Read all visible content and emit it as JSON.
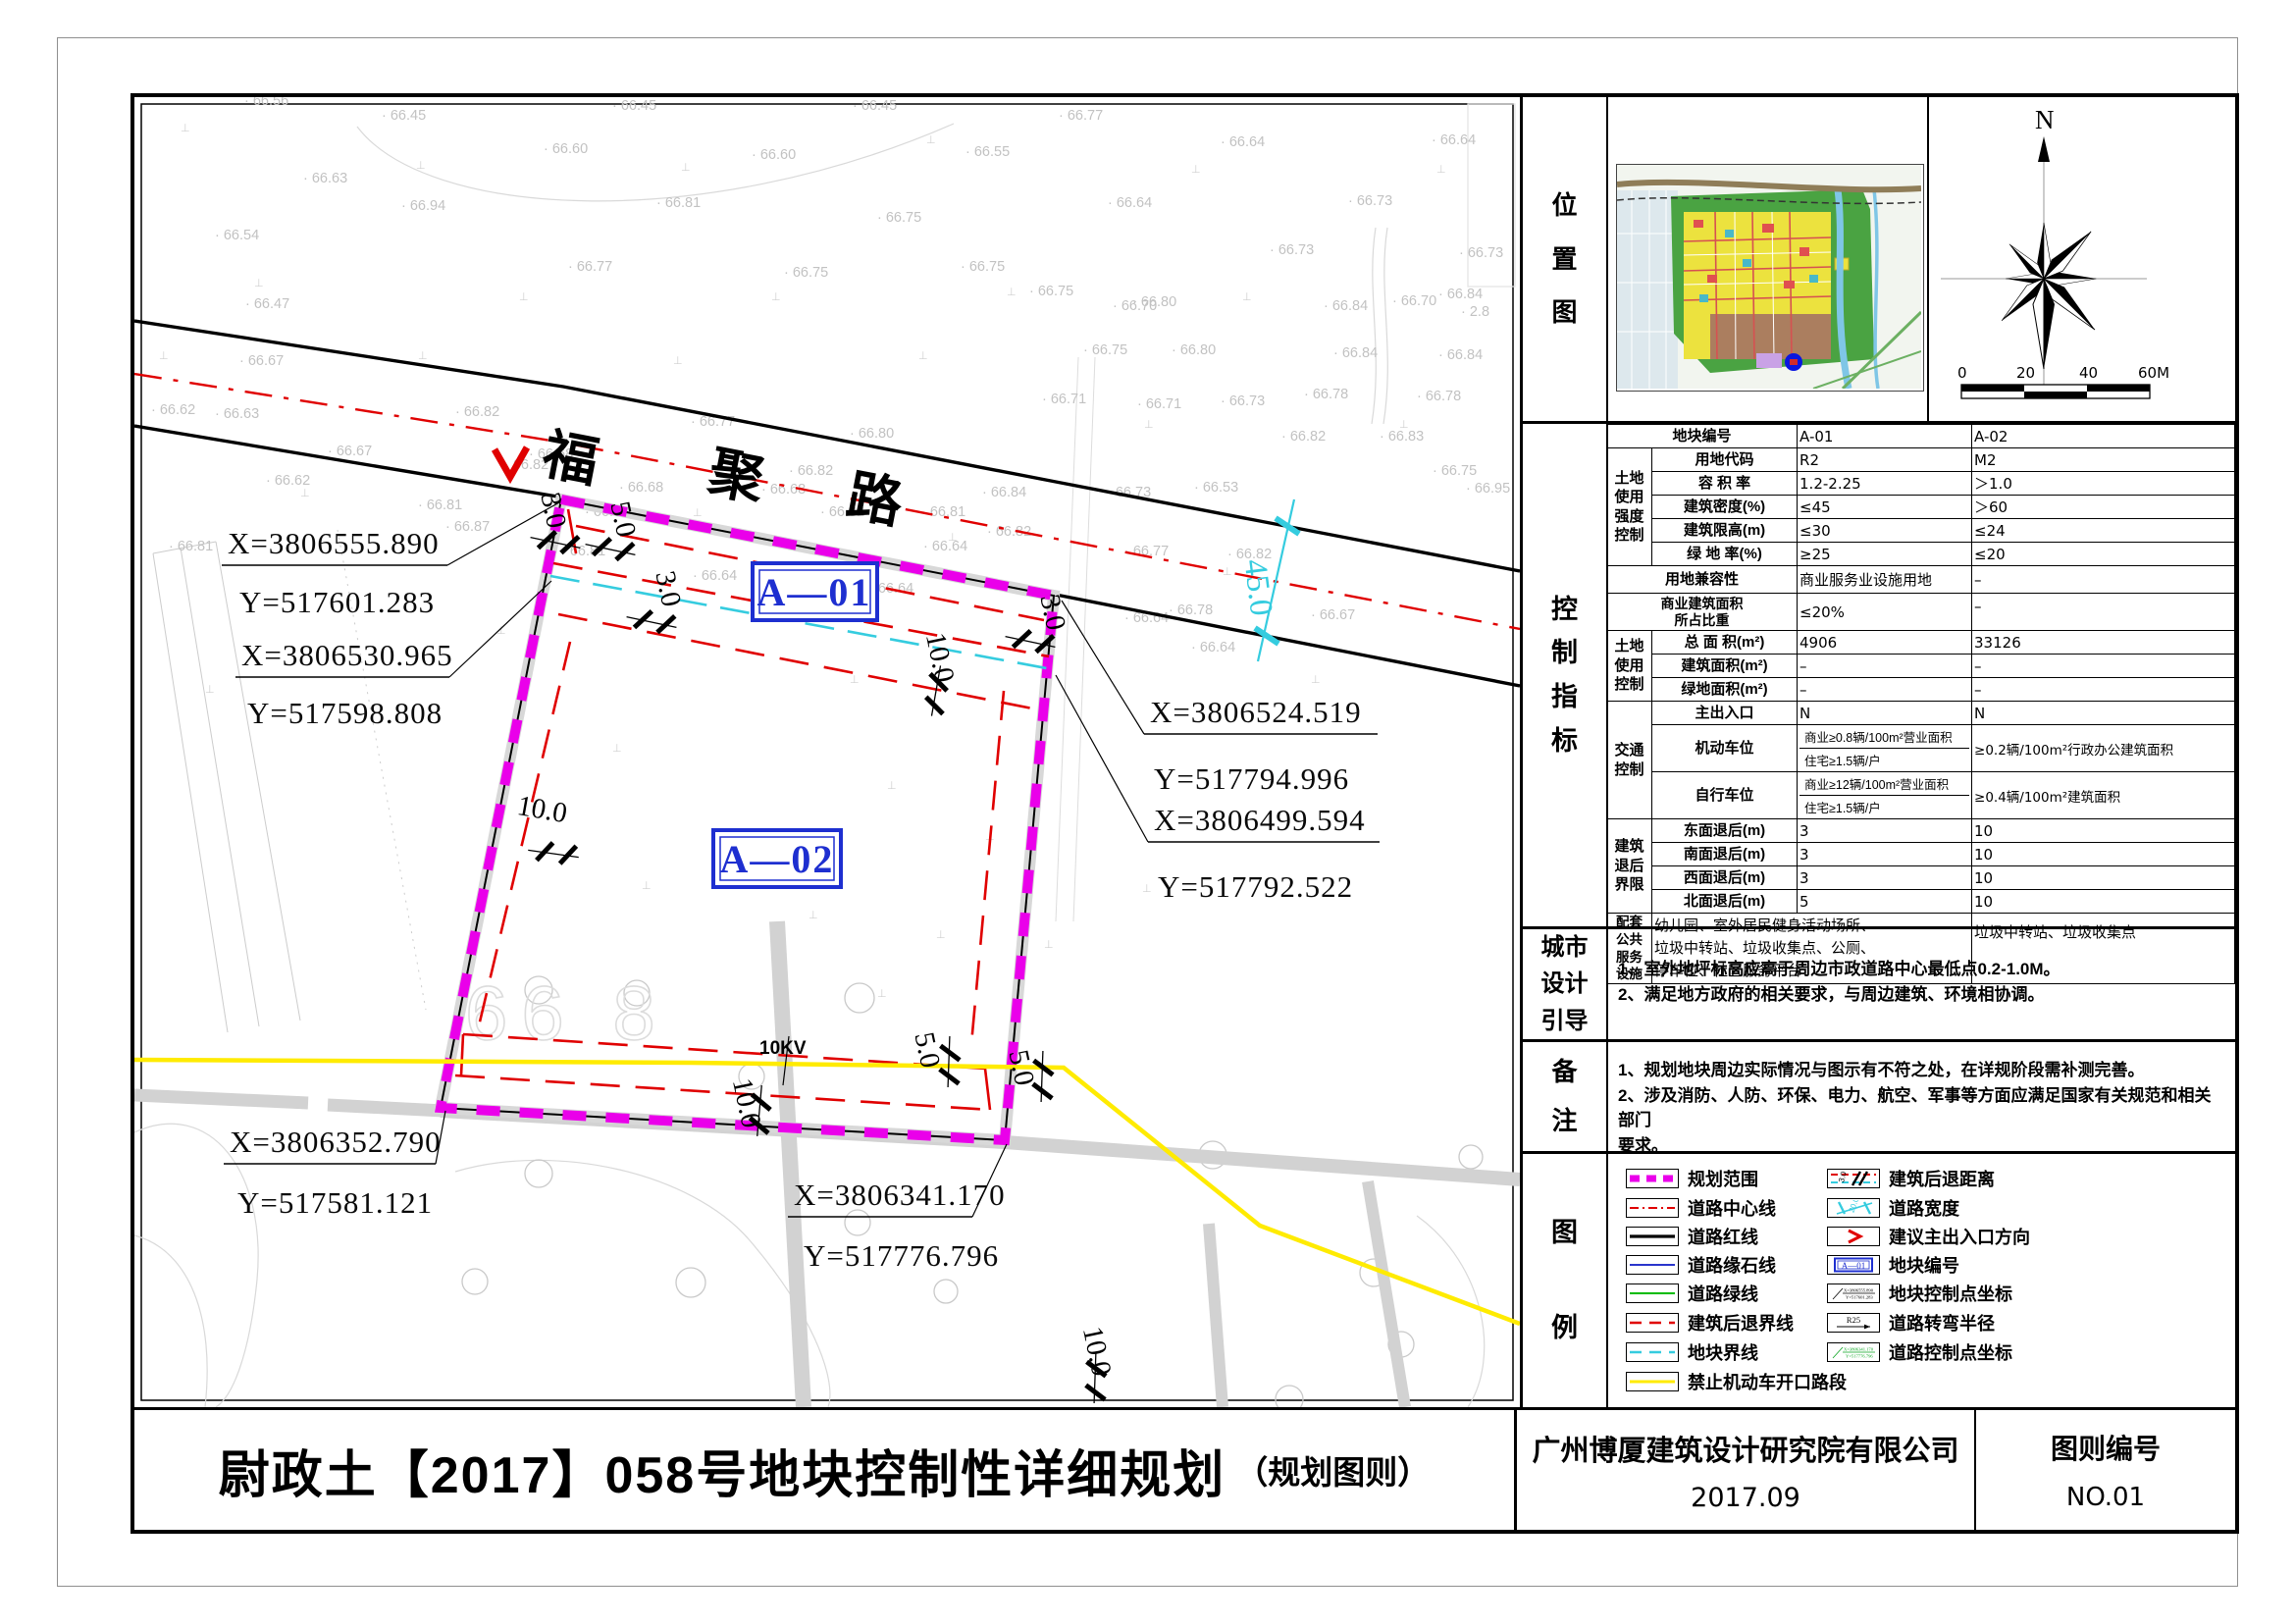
{
  "titleblock": {
    "title": "尉政土【2017】058号地块控制性详细规划",
    "title_suffix": "（规划图则）",
    "company": "广州博厦建筑设计研究院有限公司",
    "date": "2017.09",
    "sheet_label": "图则编号",
    "sheet_no": "NO.01"
  },
  "location": {
    "label": "位\n置\n图",
    "north": "N",
    "scale_ticks": {
      "t0": "0",
      "t1": "20",
      "t2": "40",
      "t3": "60M"
    }
  },
  "indicators": {
    "label": "控\n制\n指\n标",
    "header": {
      "plot_no_label": "地块编号",
      "a01": "A-01",
      "a02": "A-02"
    },
    "groups": {
      "g1": "土地\n使用\n强度\n控制",
      "g2": "土地\n使用\n控制",
      "g3": "交通\n控制",
      "g4": "建筑\n退后\n界限",
      "g5": "配套\n公共\n服务\n设施"
    },
    "rows": {
      "land_code": {
        "label": "用地代码",
        "a01": "R2",
        "a02": "M2"
      },
      "far": {
        "label": "容 积 率",
        "a01": "1.2-2.25",
        "a02": "＞1.0"
      },
      "density": {
        "label": "建筑密度(%)",
        "a01": "≤45",
        "a02": "＞60"
      },
      "height": {
        "label": "建筑限高(m)",
        "a01": "≤30",
        "a02": "≤24"
      },
      "green_rate": {
        "label": "绿 地 率(%)",
        "a01": "≥25",
        "a02": "≤20"
      },
      "compat": {
        "label": "用地兼容性",
        "a01": "商业服务业设施用地",
        "a02": "–"
      },
      "biz_ratio": {
        "label": "商业建筑面积\n所占比重",
        "a01": "≤20%",
        "a02": "–"
      },
      "total_area": {
        "label": "总 面 积(m²)",
        "a01": "4906",
        "a02": "33126"
      },
      "build_area": {
        "label": "建筑面积(m²)",
        "a01": "–",
        "a02": "–"
      },
      "green_area": {
        "label": "绿地面积(m²)",
        "a01": "–",
        "a02": "–"
      },
      "entrance": {
        "label": "主出入口",
        "a01": "N",
        "a02": "N"
      },
      "parking": {
        "label": "机动车位",
        "a01_top": "商业≥0.8辆/100m²营业面积",
        "a01_bottom": "住宅≥1.5辆/户",
        "a02": "≥0.2辆/100m²行政办公建筑面积"
      },
      "bike": {
        "label": "自行车位",
        "a01_top": "商业≥12辆/100m²营业面积",
        "a01_bottom": "住宅≥1.5辆/户",
        "a02": "≥0.4辆/100m²建筑面积"
      },
      "east": {
        "label": "东面退后(m)",
        "a01": "3",
        "a02": "10"
      },
      "south": {
        "label": "南面退后(m)",
        "a01": "3",
        "a02": "10"
      },
      "west": {
        "label": "西面退后(m)",
        "a01": "3",
        "a02": "10"
      },
      "north": {
        "label": "北面退后(m)",
        "a01": "5",
        "a02": "10"
      },
      "services": {
        "a01": "幼儿园、室外居民健身活动场所、\n垃圾中转站、垃圾收集点、公厕、\n停车位、社区服务平台",
        "a02": "垃圾中转站、垃圾收集点"
      }
    }
  },
  "urban_design": {
    "label": "城市\n设计\n引导",
    "line1": "1、室外地坪标高应高于周边市政道路中心最低点0.2-1.0M。",
    "line2": "2、满足地方政府的相关要求，与周边建筑、环境相协调。"
  },
  "notes": {
    "label": "备\n注",
    "line1": "1、规划地块周边实际情况与图示有不符之处，在详规阶段需补测完善。",
    "line2": "2、涉及消防、人防、环保、电力、航空、军事等方面应满足国家有关规范和相关部门",
    "line3": "要求。"
  },
  "legend": {
    "label": "图\n例",
    "left": [
      "规划范围",
      "道路中心线",
      "道路红线",
      "道路缘石线",
      "道路绿线",
      "建筑后退界线",
      "地块界线",
      "禁止机动车开口路段"
    ],
    "right": [
      "建筑后退距离",
      "道路宽度",
      "建议主出入口方向",
      "地块编号",
      "地块控制点坐标",
      "道路转弯半径",
      "道路控制点坐标"
    ],
    "sym": {
      "setback_dim": "3.0",
      "road_width": "20.0",
      "plot_no": "A—01",
      "radius": "R25",
      "pt_x": "X=3806555.890",
      "pt_y": "Y=517601.283",
      "rd_x": "X=3806341.170",
      "rd_y": "Y=517776.796"
    }
  },
  "map": {
    "road_chars": {
      "c0": "福",
      "c1": "聚",
      "c2": "路"
    },
    "plot_labels": {
      "a01": "A—01",
      "a02": "A—02"
    },
    "road_width_dim": "45.0",
    "power_line": "10KV",
    "contour_label": "66 8",
    "dims": {
      "d0": "3.0",
      "d1": "5.0",
      "d2": "3.0",
      "d3": "3.0",
      "d4": "10.0",
      "d5": "10.0",
      "d6": "10.0",
      "d7": "5.0",
      "d8": "5.0",
      "d9": "10.0"
    },
    "callouts": [
      {
        "x": "X=3806555.890",
        "y": "Y=517601.283"
      },
      {
        "x": "X=3806530.965",
        "y": "Y=517598.808"
      },
      {
        "x": "X=3806524.519",
        "y": "Y=517794.996"
      },
      {
        "x": "X=3806499.594",
        "y": "Y=517792.522"
      },
      {
        "x": "X=3806352.790",
        "y": "Y=517581.121"
      },
      {
        "x": "X=3806341.170",
        "y": "Y=517776.796"
      }
    ],
    "spots": [
      [
        245,
        103,
        "66.56"
      ],
      [
        385,
        118,
        "66.45"
      ],
      [
        620,
        108,
        "66.45"
      ],
      [
        865,
        108,
        "66.45"
      ],
      [
        1075,
        118,
        "66.77"
      ],
      [
        550,
        152,
        "66.60"
      ],
      [
        762,
        158,
        "66.60"
      ],
      [
        980,
        155,
        "66.55"
      ],
      [
        1240,
        145,
        "66.64"
      ],
      [
        1455,
        143,
        "66.64"
      ],
      [
        305,
        182,
        "66.63"
      ],
      [
        405,
        210,
        "66.94"
      ],
      [
        665,
        207,
        "66.81"
      ],
      [
        890,
        222,
        "66.75"
      ],
      [
        1125,
        207,
        "66.64"
      ],
      [
        1370,
        205,
        "66.73"
      ],
      [
        215,
        240,
        "66.54"
      ],
      [
        575,
        272,
        "66.77"
      ],
      [
        795,
        278,
        "66.75"
      ],
      [
        975,
        272,
        "66.75"
      ],
      [
        1290,
        255,
        "66.73"
      ],
      [
        1483,
        258,
        "66.73"
      ],
      [
        1130,
        312,
        "66.70"
      ],
      [
        1415,
        307,
        "66.70"
      ],
      [
        246,
        310,
        "66.47"
      ],
      [
        1045,
        297,
        "66.75"
      ],
      [
        1150,
        308,
        "66.80"
      ],
      [
        1345,
        312,
        "66.84"
      ],
      [
        1462,
        300,
        "66.84"
      ],
      [
        1485,
        318,
        "2.8"
      ],
      [
        1100,
        357,
        "66.75"
      ],
      [
        1190,
        357,
        "66.80"
      ],
      [
        1355,
        360,
        "66.84"
      ],
      [
        1462,
        362,
        "66.84"
      ],
      [
        1058,
        407,
        "66.71"
      ],
      [
        1155,
        412,
        "66.71"
      ],
      [
        1240,
        409,
        "66.73"
      ],
      [
        1325,
        402,
        "66.78"
      ],
      [
        1440,
        404,
        "66.78"
      ],
      [
        1302,
        445,
        "66.82"
      ],
      [
        1402,
        445,
        "66.83"
      ],
      [
        1124,
        502,
        "66.73"
      ],
      [
        1213,
        497,
        "66.53"
      ],
      [
        1456,
        480,
        "66.75"
      ],
      [
        1490,
        498,
        "66.95"
      ],
      [
        215,
        422,
        "66.63"
      ],
      [
        330,
        460,
        "66.67"
      ],
      [
        460,
        420,
        "66.82"
      ],
      [
        700,
        430,
        "66.77"
      ],
      [
        267,
        490,
        "66.62"
      ],
      [
        510,
        474,
        "66.82"
      ],
      [
        800,
        480,
        "66.82"
      ],
      [
        592,
        522,
        "66.82"
      ],
      [
        832,
        522,
        "66.82"
      ],
      [
        935,
        522,
        "66.81"
      ],
      [
        535,
        463,
        "66.68"
      ],
      [
        862,
        442,
        "66.80"
      ],
      [
        997,
        502,
        "66.84"
      ],
      [
        627,
        497,
        "66.68"
      ],
      [
        772,
        499,
        "66.68"
      ],
      [
        568,
        562,
        "66.81"
      ],
      [
        1002,
        542,
        "66.82"
      ],
      [
        1142,
        562,
        "66.77"
      ],
      [
        1247,
        565,
        "66.82"
      ],
      [
        937,
        557,
        "66.64"
      ],
      [
        702,
        587,
        "66.64"
      ],
      [
        882,
        600,
        "66.64"
      ],
      [
        1187,
        622,
        "66.78"
      ],
      [
        1142,
        630,
        "66.64"
      ],
      [
        1332,
        627,
        "66.67"
      ],
      [
        450,
        537,
        "66.87"
      ],
      [
        422,
        515,
        "66.81"
      ],
      [
        168,
        557,
        "66.81"
      ],
      [
        1210,
        660,
        "66.64"
      ],
      [
        240,
        368,
        "66.67"
      ],
      [
        150,
        418,
        "66.62"
      ]
    ],
    "tmarks": [
      [
        180,
        130
      ],
      [
        420,
        168
      ],
      [
        690,
        170
      ],
      [
        940,
        142
      ],
      [
        1210,
        172
      ],
      [
        1460,
        172
      ],
      [
        255,
        288
      ],
      [
        525,
        302
      ],
      [
        782,
        302
      ],
      [
        1022,
        297
      ],
      [
        1262,
        302
      ],
      [
        158,
        362
      ],
      [
        422,
        362
      ],
      [
        682,
        367
      ],
      [
        932,
        362
      ],
      [
        1162,
        432
      ],
      [
        1422,
        432
      ],
      [
        302,
        502
      ],
      [
        702,
        522
      ],
      [
        962,
        547
      ],
      [
        1242,
        582
      ],
      [
        502,
        642
      ],
      [
        862,
        692
      ],
      [
        1332,
        692
      ],
      [
        205,
        702
      ],
      [
        620,
        762
      ],
      [
        900,
        800
      ],
      [
        1000,
        852
      ],
      [
        650,
        902
      ],
      [
        820,
        932
      ],
      [
        950,
        952
      ],
      [
        890,
        1012
      ],
      [
        1060,
        962
      ],
      [
        1160,
        905
      ]
    ]
  },
  "colors": {
    "boundary": "#ea00ea",
    "setback_red": "#e00000",
    "plot_cyan": "#35ccdf",
    "no_open_yellow": "#ffeb00",
    "plot_no_blue": "#1e2fd0"
  }
}
